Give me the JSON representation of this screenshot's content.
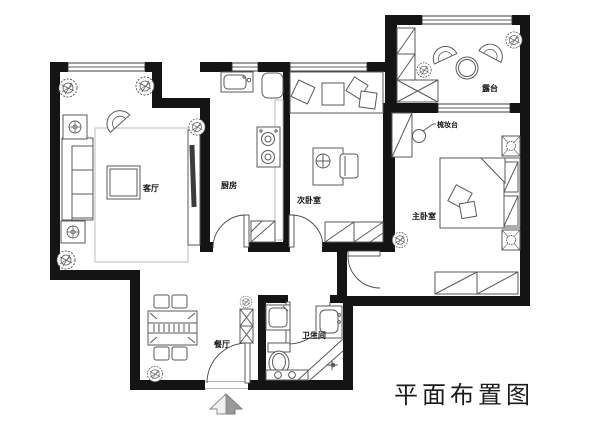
{
  "title": {
    "text": "平面布置图"
  },
  "rooms": {
    "living": {
      "label": "客厅"
    },
    "kitchen": {
      "label": "厨房"
    },
    "bedroom2": {
      "label": "次卧室"
    },
    "master": {
      "label": "主卧室"
    },
    "terrace": {
      "label": "露台"
    },
    "dining": {
      "label": "餐厅"
    },
    "bathroom": {
      "label": "卫生间"
    },
    "dressing_table": {
      "label": "梳妆台"
    }
  },
  "icons": {
    "north_arrow": "north-arrow"
  },
  "colors": {
    "wall": "#141414",
    "furniture_line": "#5a5a5a",
    "background": "#ffffff"
  }
}
